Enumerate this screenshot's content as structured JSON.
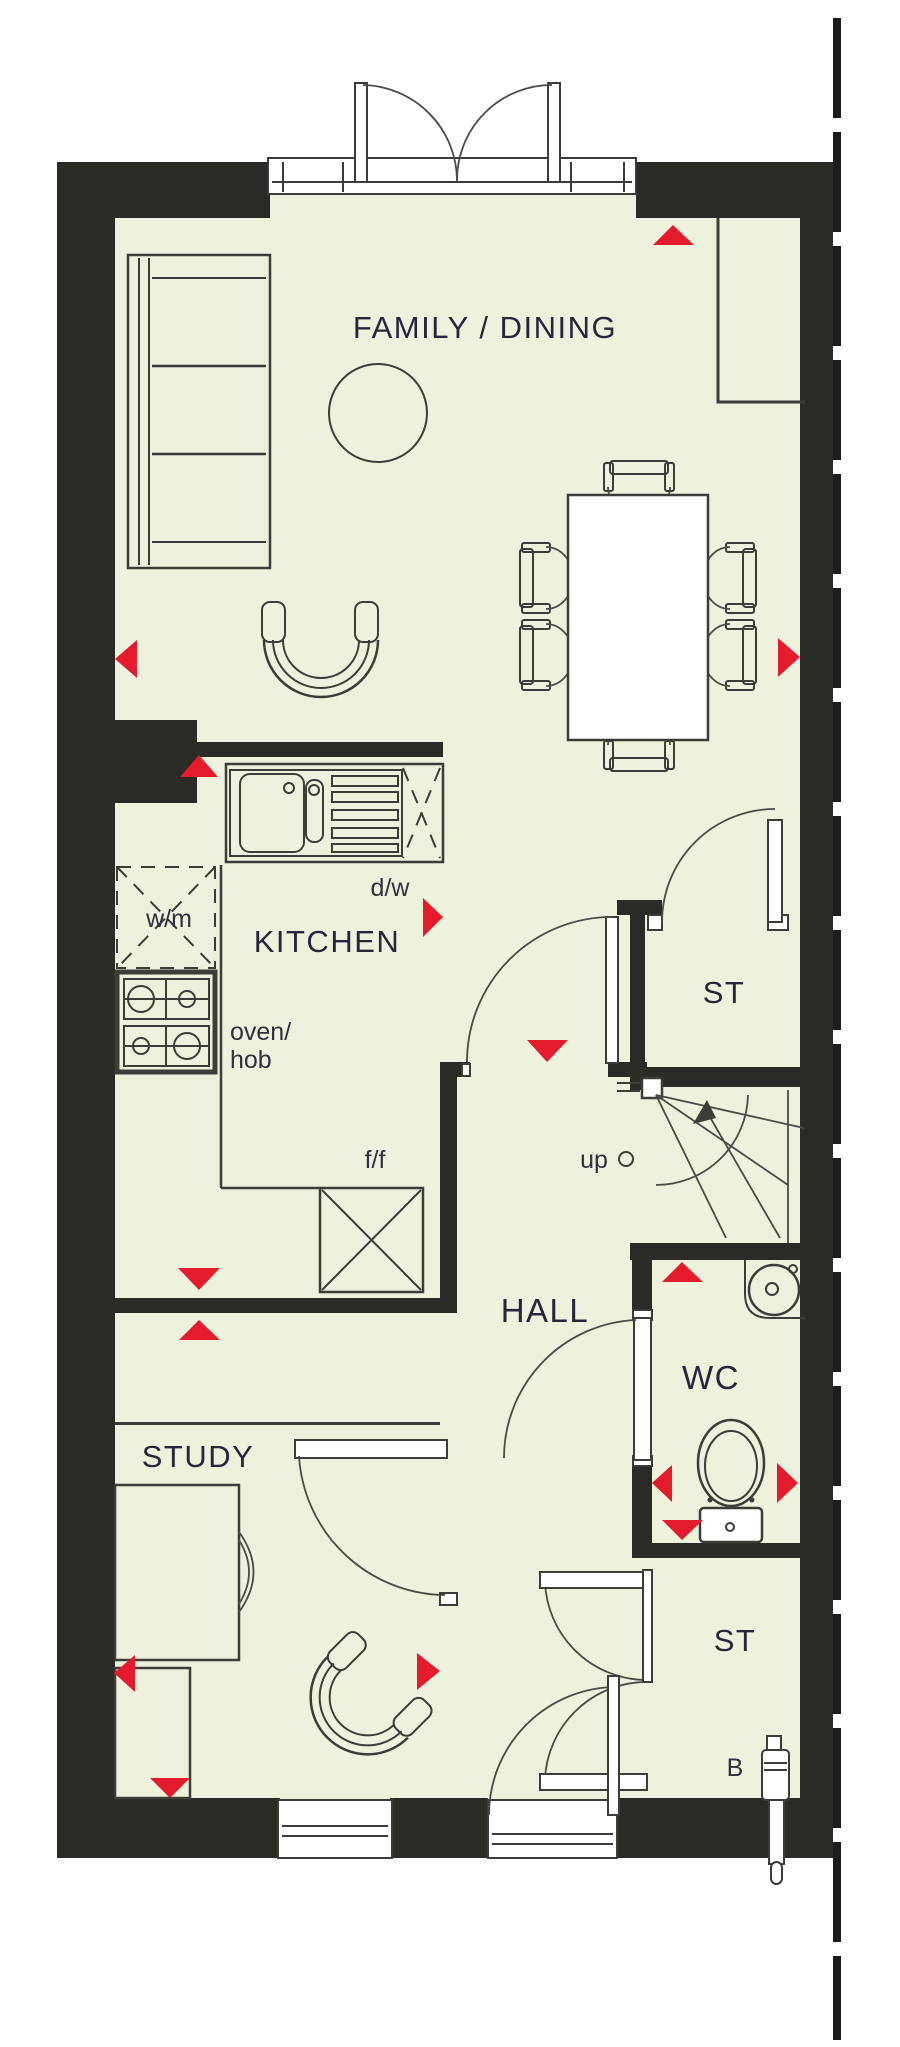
{
  "floorplan": {
    "rooms": {
      "family_dining": "FAMILY / DINING",
      "kitchen": "KITCHEN",
      "hall": "HALL",
      "study": "STUDY",
      "wc": "WC",
      "storage_upper": "ST",
      "storage_lower": "ST"
    },
    "annotations": {
      "dishwasher": "d/w",
      "washing_machine": "w/m",
      "oven_line1": "oven/",
      "oven_line2": "hob",
      "fridge_freezer": "f/f",
      "stairs_direction": "up",
      "boiler": "B"
    },
    "colors": {
      "floor": "#eef2dc",
      "wall": "#2a2a27",
      "line": "#3c3c38",
      "marker": "#e41b2c",
      "room_label": "#26263f",
      "annotation_label": "#2e3140"
    }
  }
}
